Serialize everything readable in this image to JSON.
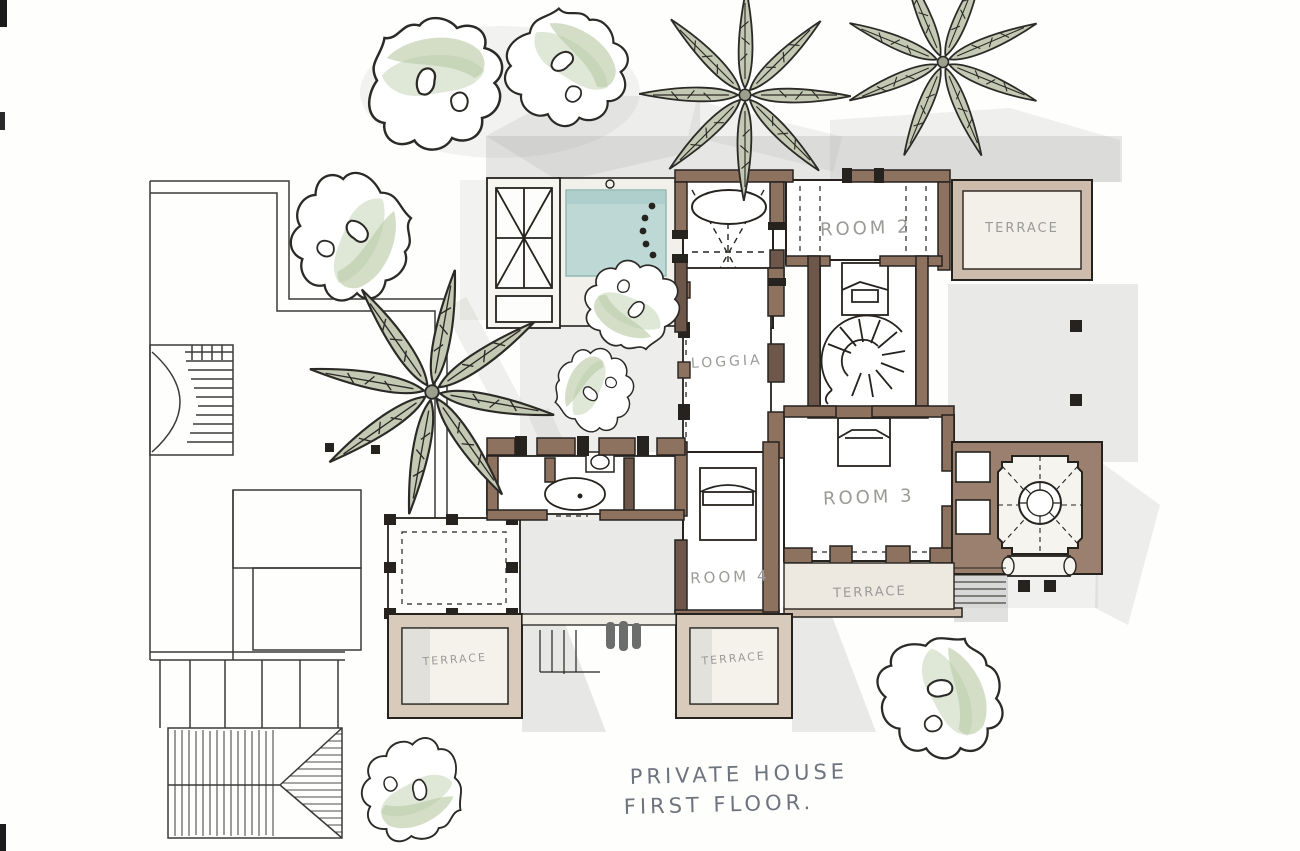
{
  "drawing": {
    "caption_line1": "PRIVATE HOUSE",
    "caption_line2": "FIRST FLOOR.",
    "labels": {
      "room2": "ROOM 2",
      "room3": "ROOM 3",
      "room4": "ROOM 4",
      "loggia": "LOGGIA",
      "terrace_top_right": "TERRACE",
      "terrace_mid": "TERRACE",
      "terrace_bottom_left": "TERRACE",
      "terrace_bottom_right": "TERRACE"
    },
    "palette": {
      "paper": "#fefefd",
      "wall_brown": "#8d7260",
      "wall_brown_dark": "#6d574a",
      "terrace_band": "#cdbbab",
      "pool_blue": "#bed9d5",
      "tree_green": "#c6d3b4",
      "palm_green": "#c4c9b4",
      "shadow_gray": "#9fa19e",
      "ink": "#26231f",
      "label_gray": "#9a9a97",
      "caption_gray": "#6e747e"
    }
  }
}
